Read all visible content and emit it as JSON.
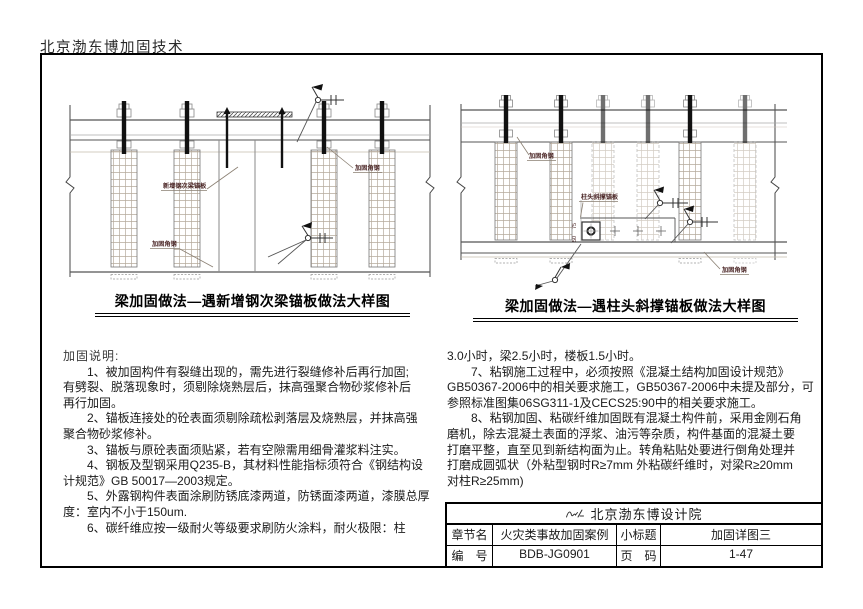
{
  "page": {
    "header": "北京渤东博加固技术"
  },
  "drawings": {
    "left": {
      "caption": "梁加固做法—遇新增钢次梁锚板做法大样图",
      "labels": {
        "plate": "新增钢次梁锚板",
        "angle_lower": "加固角钢",
        "angle_upper": "加固角钢"
      }
    },
    "right": {
      "caption": "梁加固做法—遇柱头斜撑锚板做法大样图",
      "labels": {
        "plate": "柱头斜撑锚板",
        "angle_upper": "加固角钢",
        "angle_lower": "加固角钢",
        "dim_a": "75",
        "dim_b": "50"
      }
    }
  },
  "notes": {
    "heading": "加固说明:",
    "left_lines": [
      "　　1、被加固构件有裂缝出现的，需先进行裂缝修补后再行加固;",
      "有劈裂、脱落现象时，须剔除烧熟层后，抹高强聚合物砂浆修补后",
      "再行加固。",
      "　　2、锚板连接处的砼表面须剔除疏松剥落层及烧熟层，并抹高强",
      "聚合物砂浆修补。",
      "　　3、锚板与原砼表面须贴紧，若有空隙需用细骨灌浆料注实。",
      "　　4、钢板及型钢采用Q235-B，其材料性能指标须符合《钢结构设",
      "计规范》GB 50017—2003规定。",
      "　　5、外露钢构件表面涂刷防锈底漆两道，防锈面漆两道，漆膜总厚",
      "度：室内不小于150um.",
      "　　6、碳纤维应按一级耐火等级要求刷防火涂料，耐火极限：柱"
    ],
    "right_lines": [
      "3.0小时，梁2.5小时，楼板1.5小时。",
      "　　7、粘钢施工过程中，必须按照《混凝土结构加固设计规范》",
      "GB50367-2006中的相关要求施工，GB50367-2006中未提及部分，可",
      "参照标准图集06SG311-1及CECS25:90中的相关要求施工。",
      "　　8、粘钢加固、粘碳纤维加固既有混凝土构件前，采用金刚石角",
      "磨机，除去混凝土表面的浮浆、油污等杂质，构件基面的混凝土要",
      "打磨平整，直至见到新结构面为止。转角粘贴处要进行倒角处理并",
      "打磨成圆弧状（外粘型钢时R≥7mm 外粘碳纤维时，对梁R≥20mm",
      "对柱R≥25mm)"
    ]
  },
  "titleblock": {
    "institute": "北京渤东博设计院",
    "row1": {
      "l1": "章节名",
      "v1": "火灾类事故加固案例",
      "l2": "小标题",
      "v2": "加固详图三"
    },
    "row2": {
      "l1": "编　号",
      "v1": "BDB-JG0901",
      "l2": "页　码",
      "v2": "1-47"
    }
  },
  "colors": {
    "line": "#000000",
    "label_text": "#4a2525",
    "hatch": "#b5aa9c"
  }
}
